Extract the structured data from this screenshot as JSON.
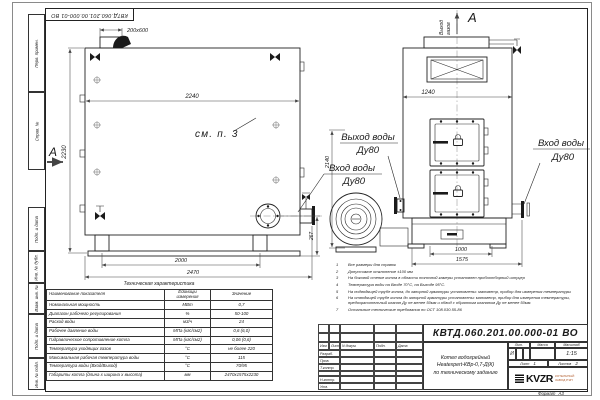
{
  "colors": {
    "line": "#1a1a1a",
    "background": "#ffffff",
    "logo_sub": "#b05a2a"
  },
  "stamp_top": {
    "designation": "КВТД.060.201.00.000-01 ВО"
  },
  "margin_fields": {
    "top": [
      "Перв. примен.",
      "Справ. №"
    ],
    "bottom": [
      "Подп. и дата",
      "Инв. № дубл.",
      "Взам. инв. №",
      "Подп. и дата",
      "Инв. № подл."
    ]
  },
  "side_view": {
    "dims": {
      "flue": "200х600",
      "width": "2240",
      "height": "2230",
      "base_inner": "2000",
      "base_outer": "2470",
      "flange_height": "267"
    },
    "note_ref": "см. п. 3",
    "section_label": "А"
  },
  "front_view": {
    "view_label": "А",
    "gas_out": {
      "line1": "Выход",
      "line2": "газов"
    },
    "dims": {
      "width": "1240",
      "height": "2140",
      "base_inner": "1000",
      "base_outer": "1575"
    }
  },
  "pipe_labels": {
    "water_out": {
      "title": "Выход воды",
      "dn": "Ду80"
    },
    "water_in": {
      "title": "Вход воды",
      "dn": "Ду80"
    },
    "water_in_right": {
      "title": "Вход воды",
      "dn": "Ду80"
    }
  },
  "spec_table": {
    "title": "Техническая характеристика",
    "headers": [
      "Наименование показателя",
      "Единицы измерения",
      "Значение"
    ],
    "rows": [
      [
        "Номинальная мощность",
        "МВт",
        "0,7"
      ],
      [
        "Диапазон рабочего регулирования",
        "%",
        "50-100"
      ],
      [
        "Расход воды",
        "м3/ч",
        "24"
      ],
      [
        "Рабочее давление воды",
        "МПа (кгс/см2)",
        "0,6 (6,0)"
      ],
      [
        "Гидравлическое сопротивление котла",
        "МПа (кгс/см2)",
        "0,06 (0,6)"
      ],
      [
        "Температура уходящих газов",
        "°С",
        "не более 220"
      ],
      [
        "Максимальная рабочая температура воды",
        "°С",
        "115"
      ],
      [
        "Температура воды (Вход/Выход)",
        "°С",
        "70/95"
      ],
      [
        "Габариты котла (длина х ширина х высота)",
        "мм",
        "2470х1575х2230"
      ]
    ]
  },
  "notes": [
    {
      "num": "1",
      "text": "Все размеры для справок"
    },
    {
      "num": "2",
      "text": "Допустимое отклонение ±100 мм"
    },
    {
      "num": "3",
      "text": "На боковой стенке котла в области топочной камеры установлен пробоотборный штуцер"
    },
    {
      "num": "4",
      "text": "Температура воды на Входе 70°С, на Выходе 95°С."
    },
    {
      "num": "5",
      "text": "На подводящей трубе котла, до запорной арматуры установлены: манометр, прибор для измерения температуры"
    },
    {
      "num": "6",
      "text": "На отводящей трубе котла до запорной арматуры установлены: манометр, прибор для измерения температуры, предохранительный клапан Ду не менее 50мм и обвод с обратным клапаном Ду не менее 50мм."
    },
    {
      "num": "7",
      "text": "Остальные технические требования по ОСТ 108.030.55-86"
    }
  ],
  "title_block": {
    "designation": "КВТД.060.201.00.000-01 ВО",
    "name_lines": [
      "Котел водогрейный",
      "Heatexpert-КВр-0,7-Д(К)",
      "по техническому заданию"
    ],
    "cols": [
      "Изм",
      "Лист",
      "N докум.",
      "Подп.",
      "Дата"
    ],
    "row_labels": [
      "Разраб.",
      "Пров.",
      "Т.контр.",
      "",
      "Н.контр.",
      "Утв."
    ],
    "lit_label": "Лит.",
    "mass_label": "Масса",
    "scale_label": "Масштаб",
    "lit_value": "И",
    "scale_value": "1:15",
    "sheet_label": "Лист",
    "sheet_value": "1",
    "sheets_label": "Листов",
    "sheets_value": "2",
    "logo_text": "KVZR",
    "logo_sub_line1": "КОТЕЛЬНЫЙ",
    "logo_sub_line2": "ЗАВОД РЭП",
    "format_label": "Формат",
    "format_value": "А3"
  }
}
